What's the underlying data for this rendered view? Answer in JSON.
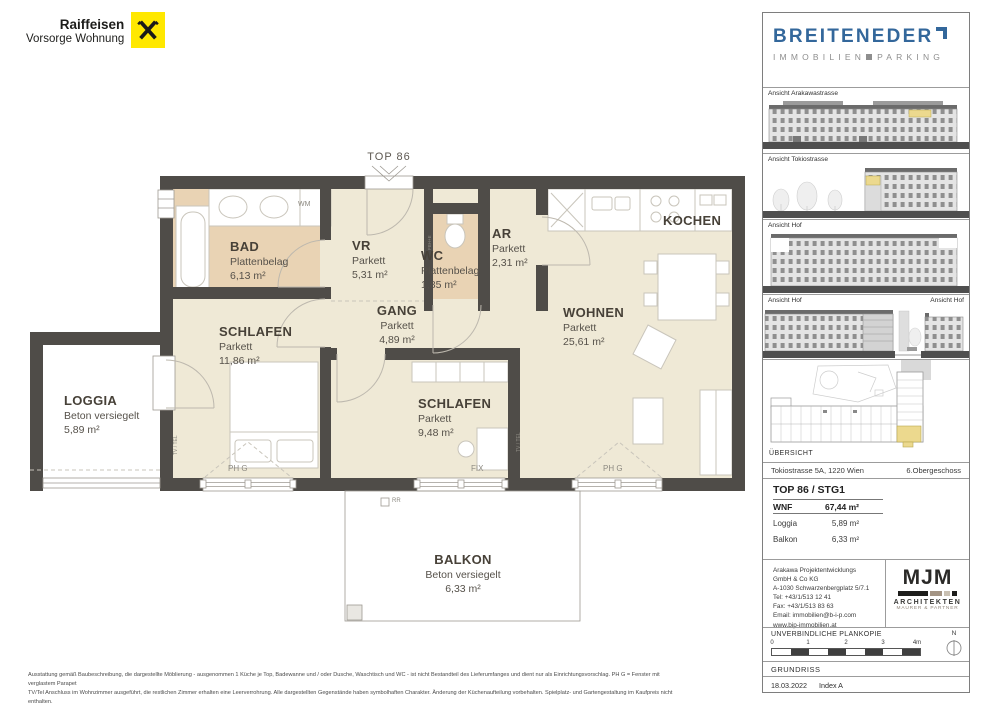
{
  "branding": {
    "line1": "Raiffeisen",
    "line2": "Vorsorge Wohnung"
  },
  "plan": {
    "entry_label": "TOP 86",
    "rooms": [
      {
        "name": "BAD",
        "floor": "Plattenbelag",
        "area": "6,13 m²"
      },
      {
        "name": "VR",
        "floor": "Parkett",
        "area": "5,31 m²"
      },
      {
        "name": "WC",
        "floor": "Plattenbelag",
        "area": "1,85 m²"
      },
      {
        "name": "AR",
        "floor": "Parkett",
        "area": "2,31 m²"
      },
      {
        "name": "KOCHEN",
        "floor": "",
        "area": ""
      },
      {
        "name": "WOHNEN",
        "floor": "Parkett",
        "area": "25,61 m²"
      },
      {
        "name": "GANG",
        "floor": "Parkett",
        "area": "4,89 m²"
      },
      {
        "name": "SCHLAFEN",
        "floor": "Parkett",
        "area": "11,86 m²"
      },
      {
        "name": "SCHLAFEN",
        "floor": "Parkett",
        "area": "9,48 m²"
      },
      {
        "name": "LOGGIA",
        "floor": "Beton versiegelt",
        "area": "5,89 m²"
      },
      {
        "name": "BALKON",
        "floor": "Beton versiegelt",
        "area": "6,33 m²"
      }
    ],
    "annotations": {
      "wm": "WM",
      "ph_g": "PH G",
      "fix": "FIX",
      "rr": "RR",
      "tv_tel": "TV / TEL",
      "fbh": "FBH+E"
    }
  },
  "sidebar": {
    "logo": {
      "name": "BREITENEDER",
      "sub_left": "IMMOBILIEN",
      "sub_right": "PARKING"
    },
    "elevations": [
      {
        "label": "Ansicht Arakawastrasse"
      },
      {
        "label": "Ansicht Tokiostrasse"
      },
      {
        "label": "Ansicht Hof"
      },
      {
        "label": "Ansicht Hof",
        "label_right": "Ansicht Hof"
      }
    ],
    "overview_label": "ÜBERSICHT",
    "address": "Tokiostrasse 5A, 1220 Wien",
    "floor_level": "6.Obergeschoss",
    "unit_title": "TOP 86 / STG1",
    "areas": [
      {
        "label": "WNF",
        "value": "67,44 m²"
      },
      {
        "label": "Loggia",
        "value": "5,89 m²"
      },
      {
        "label": "Balkon",
        "value": "6,33 m²"
      }
    ],
    "contact_lines": [
      "Arakawa Projektentwicklungs",
      "GmbH & Co KG",
      "A-1030 Schwarzenbergplatz 5/7.1",
      "Tel: +43/1/513 12 41",
      "Fax: +43/1/513 83 63",
      "Email: immobilien@b-i-p.com",
      "www.bip-immobilien.at"
    ],
    "architects": {
      "logo": "MJM",
      "line1": "ARCHITEKTEN",
      "line2": "MAURER & PARTNER"
    },
    "plan_copy_note": "UNVERBINDLICHE PLANKOPIE",
    "scale": {
      "t0": "0",
      "t1": "1",
      "t2": "2",
      "t3": "3",
      "t4": "4m",
      "north": "N"
    },
    "drawing_type": "GRUNDRISS",
    "date": "18.03.2022",
    "index": "Index A"
  },
  "footer": {
    "line1": "Ausstattung gemäß Baubeschreibung, die dargestellte Möblierung - ausgenommen 1 Küche je Top, Badewanne und / oder Dusche, Waschtisch und WC - ist nicht Bestandteil des Lieferumfanges und dient nur als Einrichtungsvorschlag. PH G = Fenster mit verglastem Parapet",
    "line2": "TV/Tel Anschluss im Wohnzimmer ausgeführt, die restlichen Zimmer erhalten eine Leerverrohrung. Alle dargestellten Gegenstände haben symbolhaften Charakter. Änderung der Küchenaufteilung vorbehalten. Spielplatz- und Gartengestaltung im Kaufpreis nicht enthalten.",
    "line3": "Druck- und Satzfehler, sowie Irrtümer und baulich bedingte Änderungen vorbehalten. Die Wohnungsgrößen sind Cirka - Angaben und können sich durch die Detailplanung geringfügig ändern. Maßgeblich ist in jedem Fall der Kaufvertrag."
  },
  "colors": {
    "raiffeisen_yellow": "#ffe800",
    "breiteneder_blue": "#33679b",
    "wall": "#4f4c48",
    "floor": "#efe9d6",
    "tile": "#e9d3b4",
    "highlight": "#ecd98e"
  }
}
